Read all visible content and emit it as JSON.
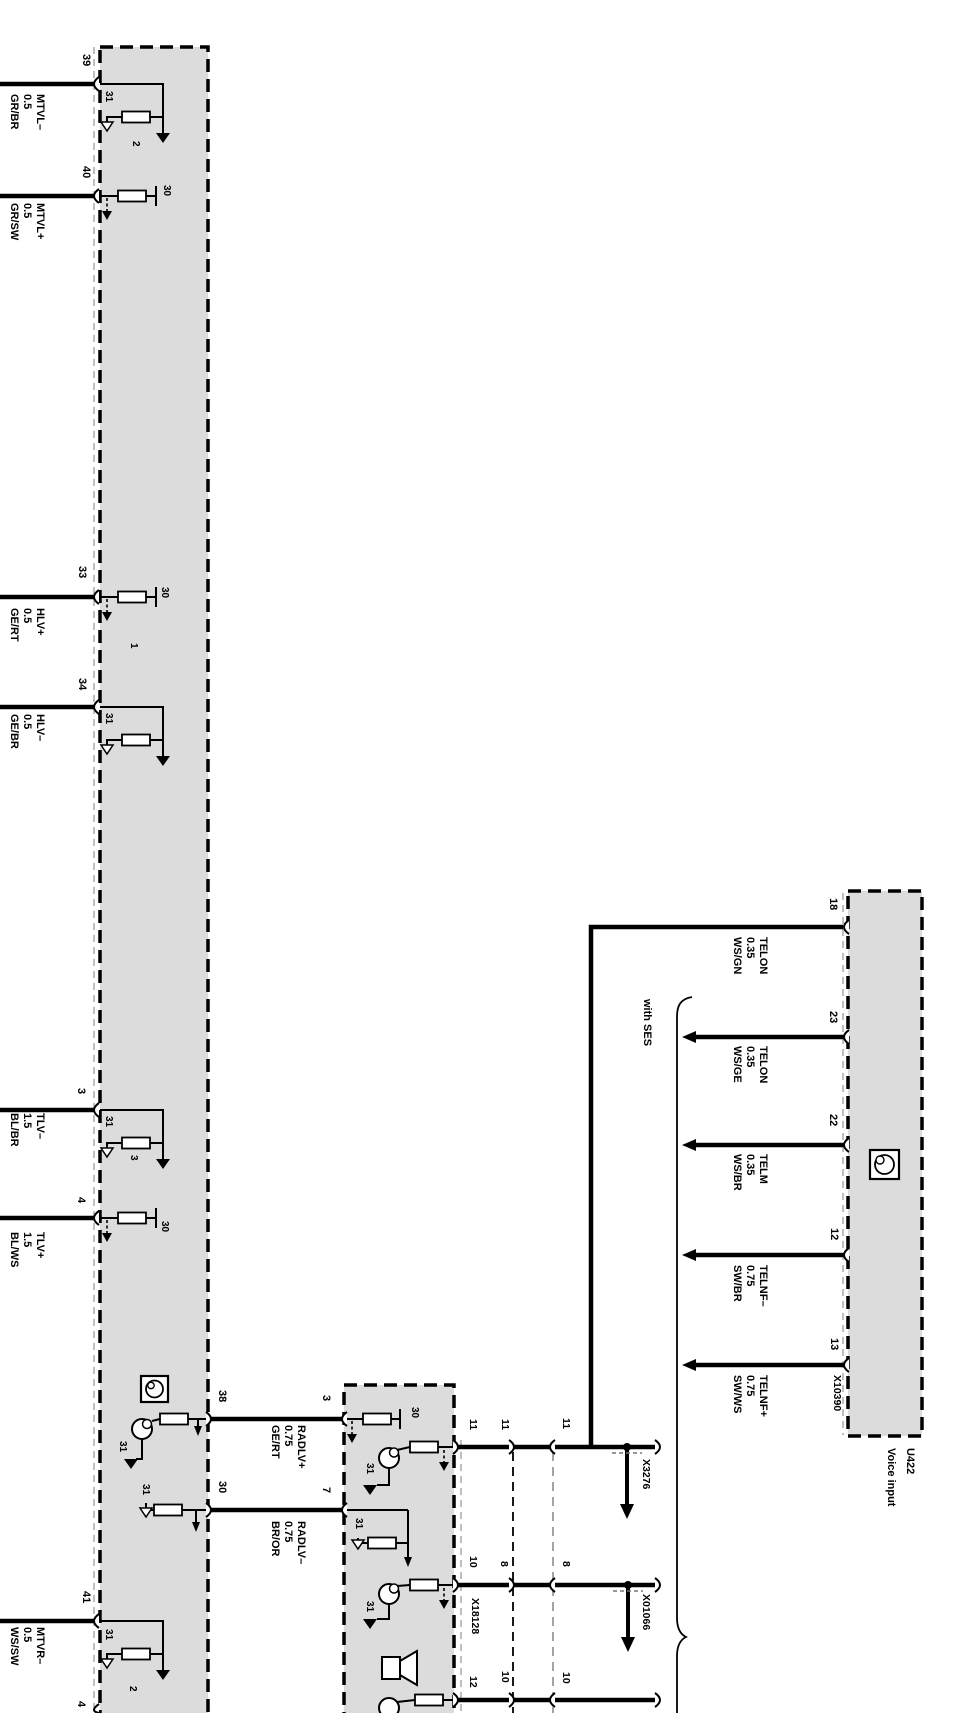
{
  "lb": {
    "p39": "39",
    "w39": "MTVL–\n0.5\nGR/BR",
    "p40": "40",
    "w40": "MTVL+\n0.5\nGR/SW",
    "p33": "33",
    "w33": "HLV+\n0.5\nGE/RT",
    "p34": "34",
    "w34": "HLV–\n0.5\nGE/BR",
    "p3": "3",
    "w3": "TLV–\n1.5\nBL/BR",
    "p4": "4",
    "w4": "TLV+\n1.5\nBL/WS",
    "p41": "41",
    "w41": "MTVR–\n0.5\nWS/SW",
    "p42": "4",
    "t39": "31",
    "t40": "30",
    "t33": "30",
    "t34": "31",
    "t3": "31",
    "t4": "30",
    "t38": "31",
    "t30": "31",
    "t41": "31",
    "c2a": "2",
    "c1": "1",
    "c3": "3",
    "c2b": "2",
    "p38": "38",
    "p30": "30",
    "w38": "RADLV+\n0.75\nGE/RT",
    "w30": "RADLV–\n0.75\nBR/OR"
  },
  "sb": {
    "p3": "3",
    "p7": "7",
    "t30": "30",
    "t31a": "31",
    "t31b": "31",
    "t31c": "31"
  },
  "runs": {
    "a1": "11",
    "a2": "11",
    "a3": "11",
    "b1": "10",
    "b2": "8",
    "b3": "8",
    "c1": "12",
    "c2": "10",
    "c3": "10",
    "x18128": "X18128",
    "x3276": "X3276",
    "x01066": "X01066"
  },
  "vi": {
    "p18": "18",
    "p23": "23",
    "p22": "22",
    "p12": "12",
    "p13": "13",
    "w18": "TELON\n0.35\nWS/GN",
    "w23": "TELON\n0.35\nWS/GE",
    "w22": "TELM\n0.35\nWS/BR",
    "w12": "TELNF–\n0.75\nSW/BR",
    "w13": "TELNF+\n0.75\nSW/WS",
    "connector": "X10390",
    "id": "U422",
    "name": "Voice input",
    "with_ses": "with SES"
  },
  "colors": {
    "box_fill": "#dcdcdc",
    "line": "#000000",
    "gray_dash": "#9a9a9a"
  }
}
